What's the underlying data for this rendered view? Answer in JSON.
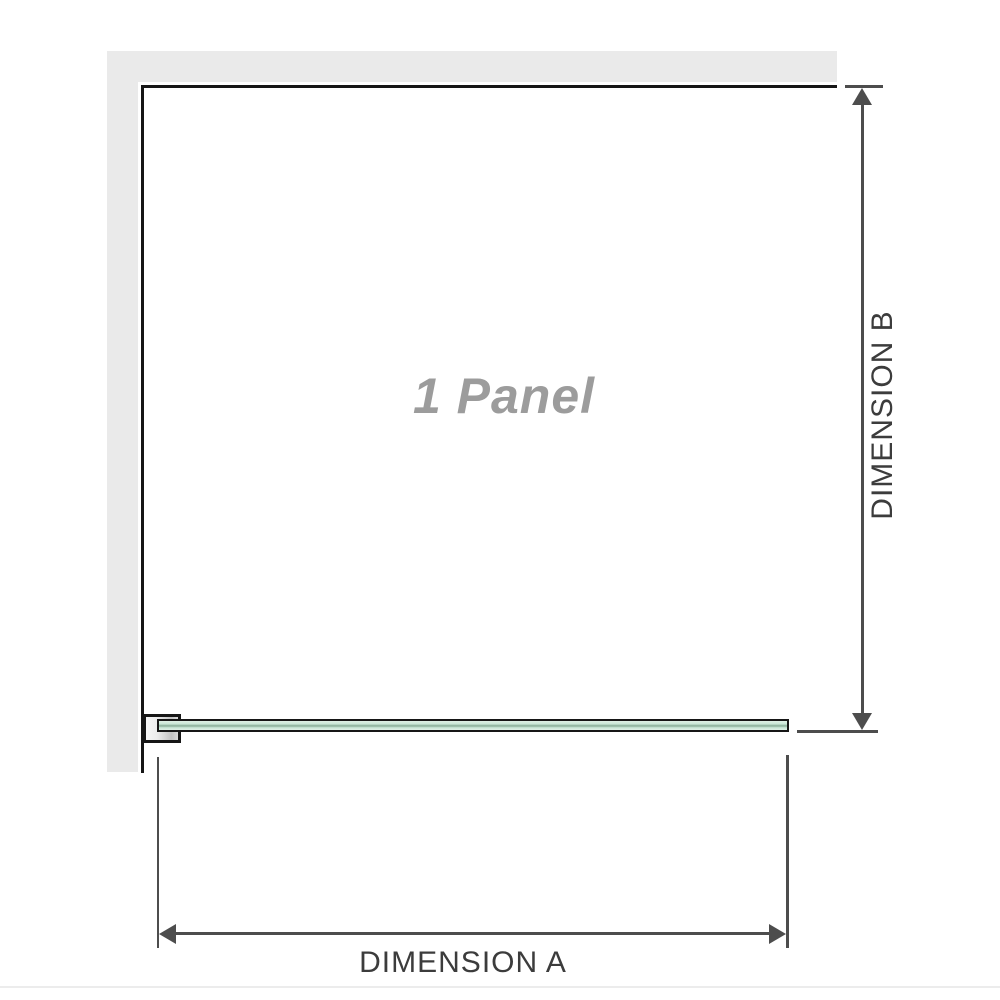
{
  "diagram": {
    "panel_label": "1 Panel",
    "dimension_a_label": "DIMENSION A",
    "dimension_b_label": "DIMENSION B"
  },
  "colors": {
    "wall": "#eaeaea",
    "outline": "#161616",
    "dimension_line": "#4d4d4d",
    "label_text": "#3c3c3c",
    "panel_label_text": "#9c9c9c",
    "glass_fill": "#c8e7d6",
    "glass_light": "#dff0e6",
    "glass_stripe": "#93b7a2",
    "divider": "#ececec"
  }
}
